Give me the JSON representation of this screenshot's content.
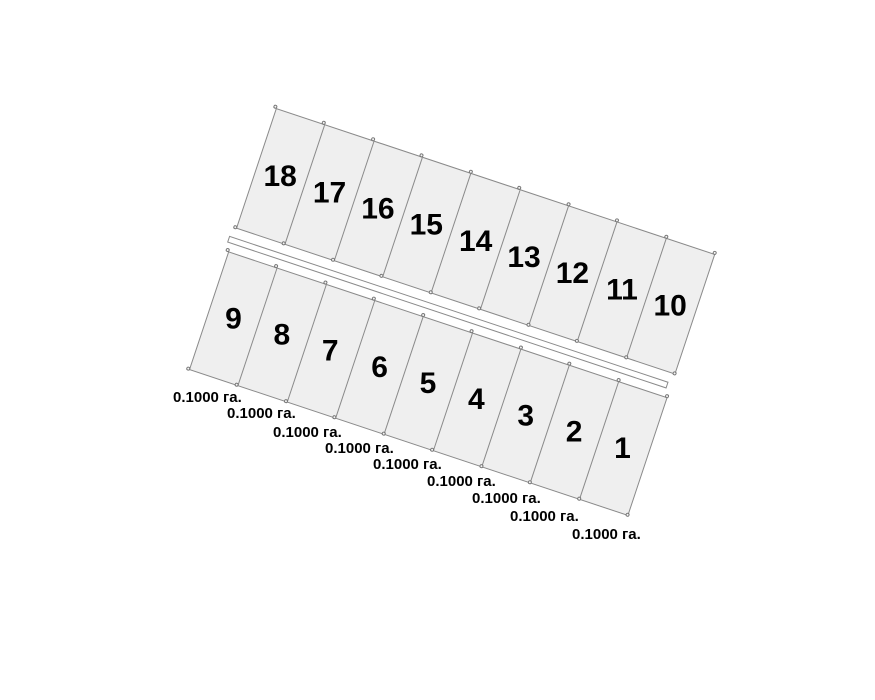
{
  "colors": {
    "parcel_fill": "#efefef",
    "line": "#8a8a8a",
    "road_fill": "#ffffff",
    "text": "#000000",
    "background": "#ffffff"
  },
  "plan": {
    "top_row": {
      "parcels": [
        {
          "number": "18"
        },
        {
          "number": "17"
        },
        {
          "number": "16"
        },
        {
          "number": "15"
        },
        {
          "number": "14"
        },
        {
          "number": "13"
        },
        {
          "number": "12"
        },
        {
          "number": "11"
        },
        {
          "number": "10"
        }
      ]
    },
    "bottom_row": {
      "parcels": [
        {
          "number": "9",
          "area_label": "0.1000 га."
        },
        {
          "number": "8",
          "area_label": "0.1000 га."
        },
        {
          "number": "7",
          "area_label": "0.1000 га."
        },
        {
          "number": "6",
          "area_label": "0.1000 га."
        },
        {
          "number": "5",
          "area_label": "0.1000 га."
        },
        {
          "number": "4",
          "area_label": "0.1000 га."
        },
        {
          "number": "3",
          "area_label": "0.1000 га."
        },
        {
          "number": "2",
          "area_label": "0.1000 га."
        },
        {
          "number": "1",
          "area_label": "0.1000 га."
        }
      ]
    }
  }
}
